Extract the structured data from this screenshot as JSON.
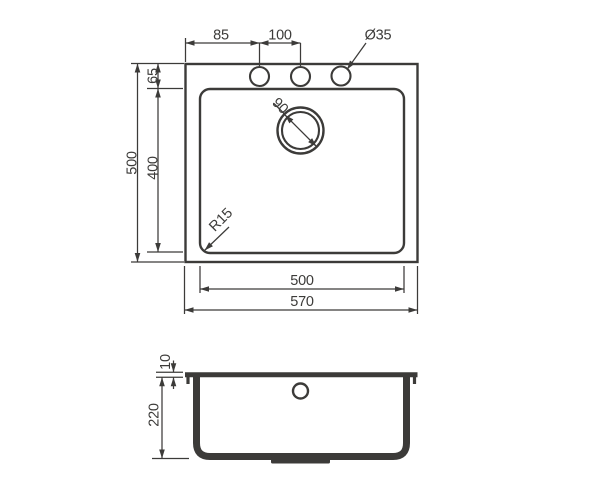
{
  "colors": {
    "line": "#3c3b39",
    "background": "#ffffff"
  },
  "top_view": {
    "dim_hole_offset": "85",
    "dim_hole_spacing": "100",
    "dim_hole_diameter": "Ø35",
    "dim_outer_height": "500",
    "dim_edge_to_holes": "65",
    "dim_bowl_height": "400",
    "dim_drain_diameter": "90",
    "dim_corner_radius": "R15",
    "dim_bowl_width": "500",
    "dim_outer_width": "570"
  },
  "side_view": {
    "dim_rim_thickness": "10",
    "dim_bowl_depth": "220"
  }
}
